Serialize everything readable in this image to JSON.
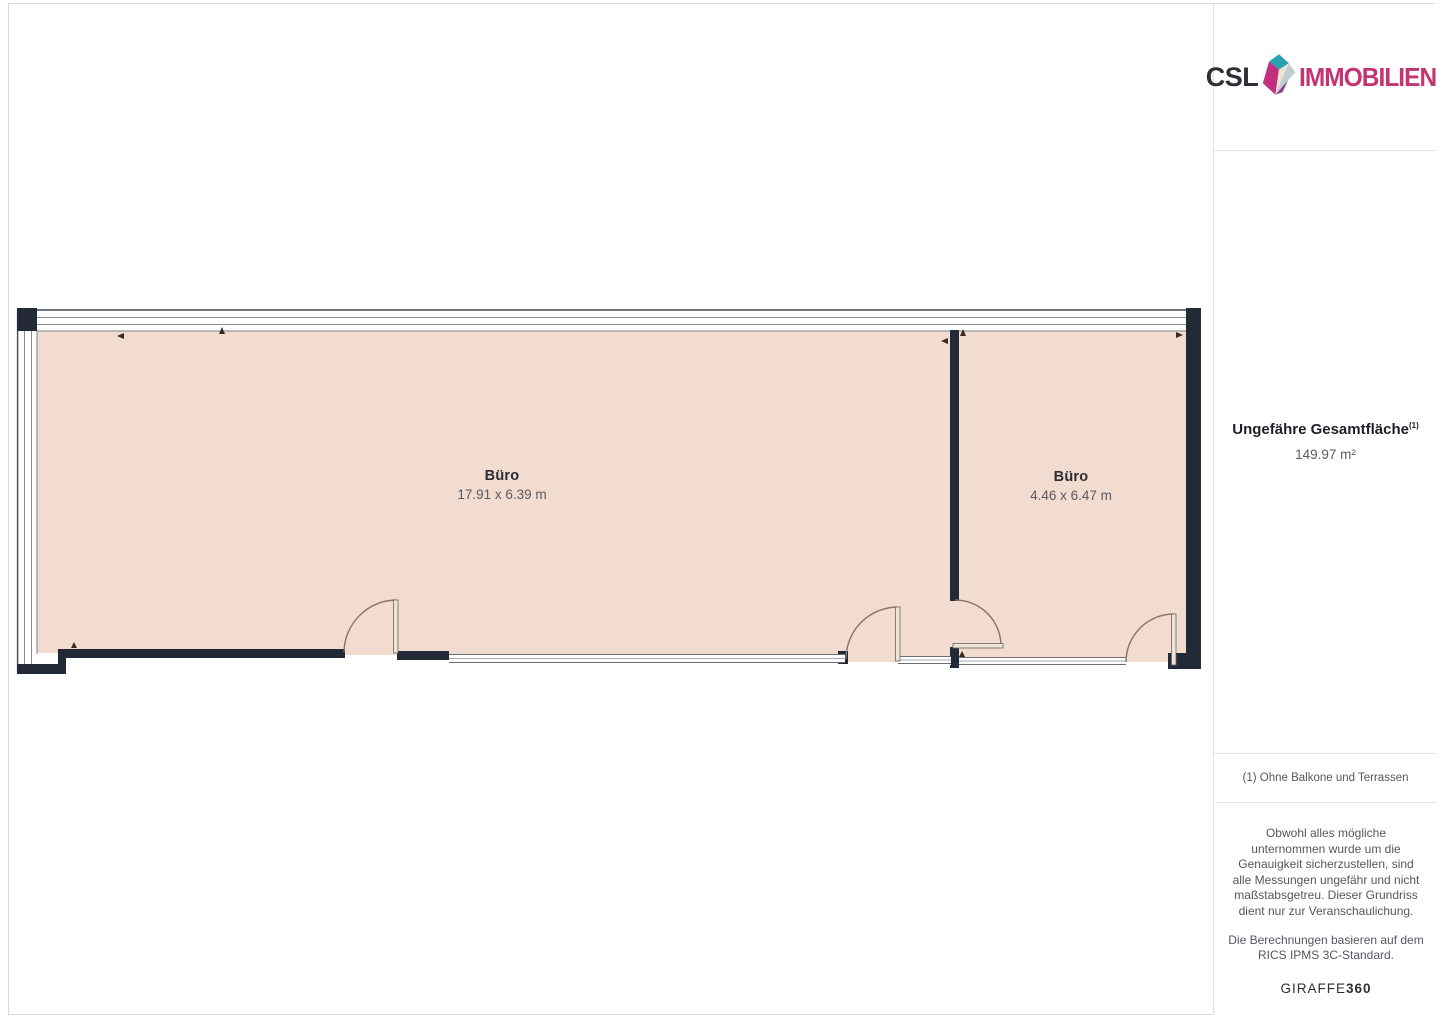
{
  "logo": {
    "brand": "CSL",
    "suffix": "IMMOBILIEN"
  },
  "floorplan": {
    "rooms": [
      {
        "name": "Büro",
        "dimensions": "17.91 x 6.39 m"
      },
      {
        "name": "Büro",
        "dimensions": "4.46 x 6.47 m"
      }
    ],
    "colors": {
      "room_fill": "#f1dccf",
      "wall": "#232a37",
      "door_arc": "#8b7364"
    }
  },
  "sidebar": {
    "area_title": "Ungefähre Gesamtfläche",
    "area_footnote_marker": "(1)",
    "area_value": "149.97 m²",
    "footnote": "(1) Ohne Balkone und Terrassen",
    "disclaimer_p1": "Obwohl alles mögliche unternommen wurde um die Genauigkeit sicherzustellen, sind alle Messungen ungefähr und nicht maßstabsgetreu. Dieser Grundriss dient nur zur Veranschaulichung.",
    "disclaimer_p2": "Die Berechnungen basieren auf dem RICS IPMS 3C-Standard.",
    "brand_footer": {
      "name": "GIRAFFE",
      "number": "360"
    }
  }
}
